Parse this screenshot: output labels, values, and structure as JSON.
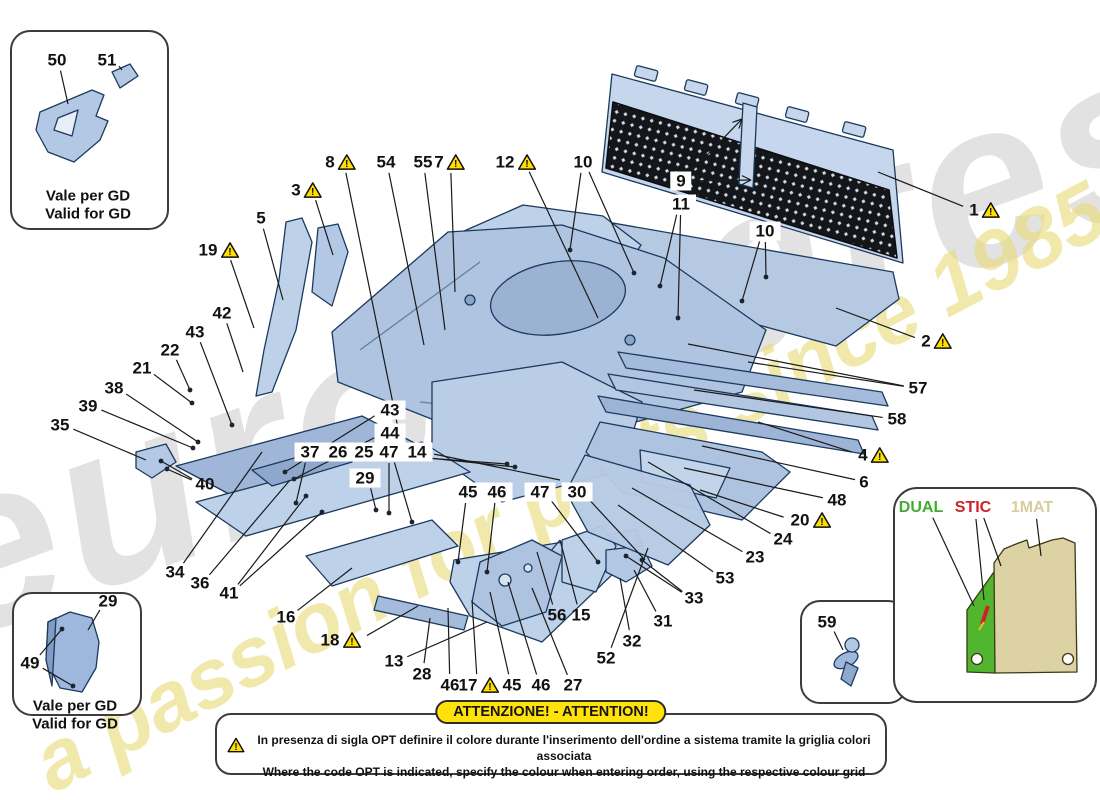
{
  "watermarks": {
    "brand": "eurospares",
    "tagline": "a passion for parts since 1985"
  },
  "banner": {
    "title": "ATTENZIONE! - ATTENTION!",
    "line_it": "In presenza di sigla OPT definire il colore durante l'inserimento dell'ordine a sistema tramite la griglia colori associata",
    "line_en": "Where the code OPT is indicated, specify the colour when entering order, using the respective colour grid"
  },
  "insets": {
    "top_left": {
      "caption1": "Vale per GD",
      "caption2": "Valid for GD"
    },
    "bottom_left": {
      "caption1": "Vale per GD",
      "caption2": "Valid for GD"
    }
  },
  "mat_legend": {
    "dual_color": "#3fae2f",
    "stic_color": "#d02027",
    "mat_color": "#d9cd9e"
  },
  "callouts": [
    {
      "n": "50",
      "x": 57,
      "y": 60,
      "tx": 68,
      "ty": 104
    },
    {
      "n": "51",
      "x": 107,
      "y": 60,
      "tx": 122,
      "ty": 70
    },
    {
      "n": "29",
      "x": 108,
      "y": 601,
      "tx": 88,
      "ty": 630
    },
    {
      "n": "49",
      "x": 30,
      "y": 663,
      "tx": 62,
      "ty": 629,
      "tx2": 73,
      "ty2": 686,
      "dot": true
    },
    {
      "n": "59",
      "x": 827,
      "y": 622,
      "tx": 843,
      "ty": 650
    },
    {
      "n": "DUAL",
      "x": 921,
      "y": 508,
      "color": "#3fae2f",
      "tx": 974,
      "ty": 606
    },
    {
      "n": "STIC",
      "x": 973,
      "y": 508,
      "color": "#d02027",
      "tx": 984,
      "ty": 600,
      "tx2": 1001,
      "ty2": 566
    },
    {
      "n": "1MAT",
      "x": 1032,
      "y": 508,
      "color": "#d9cd9e",
      "tx": 1041,
      "ty": 556
    },
    {
      "n": "3",
      "x": 307,
      "y": 190,
      "warn": true,
      "tx": 333,
      "ty": 255
    },
    {
      "n": "5",
      "x": 261,
      "y": 218,
      "tx": 283,
      "ty": 300
    },
    {
      "n": "19",
      "x": 219,
      "y": 250,
      "warn": true,
      "tx": 254,
      "ty": 328
    },
    {
      "n": "8",
      "x": 341,
      "y": 162,
      "warn": true,
      "tx": 398,
      "ty": 428
    },
    {
      "n": "54",
      "x": 386,
      "y": 162,
      "tx": 424,
      "ty": 345
    },
    {
      "n": "55",
      "x": 423,
      "y": 162,
      "tx": 445,
      "ty": 330
    },
    {
      "n": "7",
      "x": 450,
      "y": 162,
      "warn": true,
      "tx": 455,
      "ty": 292
    },
    {
      "n": "12",
      "x": 516,
      "y": 162,
      "warn": true,
      "tx": 598,
      "ty": 318
    },
    {
      "n": "10",
      "x": 583,
      "y": 162,
      "tx": 570,
      "ty": 250,
      "tx2": 634,
      "ty2": 273,
      "dot": true
    },
    {
      "n": "9",
      "x": 681,
      "y": 181,
      "boxed": true,
      "tx": 742,
      "ty": 119,
      "tx2": 751,
      "ty2": 180,
      "arrow": true
    },
    {
      "n": "11",
      "x": 681,
      "y": 204,
      "boxed": true,
      "tx": 660,
      "ty": 286,
      "tx2": 678,
      "ty2": 318,
      "dot": true
    },
    {
      "n": "10",
      "x": 765,
      "y": 231,
      "boxed": true,
      "tx": 766,
      "ty": 277,
      "tx2": 742,
      "ty2": 301,
      "dot": true
    },
    {
      "n": "1",
      "x": 985,
      "y": 210,
      "warn": true,
      "tx": 878,
      "ty": 172
    },
    {
      "n": "2",
      "x": 937,
      "y": 341,
      "warn": true,
      "tx": 836,
      "ty": 308
    },
    {
      "n": "57",
      "x": 918,
      "y": 388,
      "tx": 748,
      "ty": 362,
      "tx2": 688,
      "ty2": 344
    },
    {
      "n": "58",
      "x": 897,
      "y": 419,
      "tx": 694,
      "ty": 390
    },
    {
      "n": "4",
      "x": 874,
      "y": 455,
      "warn": true,
      "tx": 758,
      "ty": 422
    },
    {
      "n": "6",
      "x": 864,
      "y": 482,
      "tx": 702,
      "ty": 446
    },
    {
      "n": "48",
      "x": 837,
      "y": 500,
      "tx": 684,
      "ty": 468
    },
    {
      "n": "20",
      "x": 811,
      "y": 520,
      "warn": true,
      "tx": 700,
      "ty": 490
    },
    {
      "n": "24",
      "x": 783,
      "y": 539,
      "tx": 648,
      "ty": 462
    },
    {
      "n": "23",
      "x": 755,
      "y": 557,
      "tx": 632,
      "ty": 488
    },
    {
      "n": "53",
      "x": 725,
      "y": 578,
      "tx": 618,
      "ty": 505
    },
    {
      "n": "33",
      "x": 694,
      "y": 598,
      "tx": 626,
      "ty": 556,
      "tx2": 642,
      "ty2": 560,
      "dot": true
    },
    {
      "n": "31",
      "x": 663,
      "y": 621,
      "tx": 634,
      "ty": 570
    },
    {
      "n": "32",
      "x": 632,
      "y": 641,
      "tx": 620,
      "ty": 578
    },
    {
      "n": "52",
      "x": 606,
      "y": 658,
      "tx": 648,
      "ty": 548
    },
    {
      "n": "15",
      "x": 581,
      "y": 615,
      "tx": 560,
      "ty": 540
    },
    {
      "n": "56",
      "x": 557,
      "y": 615,
      "tx": 537,
      "ty": 552
    },
    {
      "n": "27",
      "x": 573,
      "y": 685,
      "tx": 532,
      "ty": 588
    },
    {
      "n": "46",
      "x": 541,
      "y": 685,
      "tx": 508,
      "ty": 582
    },
    {
      "n": "45",
      "x": 512,
      "y": 685,
      "tx": 490,
      "ty": 592
    },
    {
      "n": "17",
      "x": 479,
      "y": 685,
      "warn": true,
      "tx": 472,
      "ty": 600
    },
    {
      "n": "46",
      "x": 450,
      "y": 685,
      "tx": 448,
      "ty": 608
    },
    {
      "n": "28",
      "x": 422,
      "y": 674,
      "tx": 430,
      "ty": 618
    },
    {
      "n": "13",
      "x": 394,
      "y": 661,
      "tx": 487,
      "ty": 622
    },
    {
      "n": "18",
      "x": 341,
      "y": 640,
      "warn": true,
      "tx": 418,
      "ty": 606
    },
    {
      "n": "16",
      "x": 286,
      "y": 617,
      "tx": 352,
      "ty": 568
    },
    {
      "n": "41",
      "x": 229,
      "y": 593,
      "tx": 306,
      "ty": 496,
      "tx2": 322,
      "ty2": 512,
      "dot": true
    },
    {
      "n": "36",
      "x": 200,
      "y": 583,
      "tx": 290,
      "ty": 480
    },
    {
      "n": "34",
      "x": 175,
      "y": 572,
      "tx": 262,
      "ty": 452
    },
    {
      "n": "35",
      "x": 60,
      "y": 425,
      "tx": 146,
      "ty": 460
    },
    {
      "n": "39",
      "x": 88,
      "y": 406,
      "tx": 193,
      "ty": 448,
      "dot": true
    },
    {
      "n": "38",
      "x": 114,
      "y": 388,
      "tx": 198,
      "ty": 442,
      "dot": true
    },
    {
      "n": "21",
      "x": 142,
      "y": 368,
      "tx": 192,
      "ty": 403,
      "dot": true
    },
    {
      "n": "22",
      "x": 170,
      "y": 350,
      "tx": 190,
      "ty": 390,
      "dot": true
    },
    {
      "n": "43",
      "x": 195,
      "y": 332,
      "tx": 232,
      "ty": 425,
      "dot": true
    },
    {
      "n": "42",
      "x": 222,
      "y": 313,
      "tx": 243,
      "ty": 372
    },
    {
      "n": "40",
      "x": 205,
      "y": 484,
      "tx": 161,
      "ty": 461,
      "tx2": 167,
      "ty2": 469,
      "dot": true
    },
    {
      "n": "43",
      "x": 390,
      "y": 410,
      "boxed": true,
      "tx": 285,
      "ty": 472,
      "dot": true
    },
    {
      "n": "44",
      "x": 390,
      "y": 433,
      "boxed": true,
      "tx": 294,
      "ty": 479,
      "dot": true
    },
    {
      "n": "37",
      "x": 310,
      "y": 452,
      "boxed": true,
      "tx": 296,
      "ty": 503,
      "dot": true
    },
    {
      "n": "26",
      "x": 338,
      "y": 452,
      "boxed": true,
      "tx": 507,
      "ty": 464,
      "dot": true
    },
    {
      "n": "25",
      "x": 364,
      "y": 452,
      "boxed": true,
      "tx": 515,
      "ty": 467,
      "dot": true
    },
    {
      "n": "47",
      "x": 389,
      "y": 452,
      "boxed": true,
      "tx": 389,
      "ty": 513,
      "tx2": 412,
      "ty2": 522,
      "dot": true
    },
    {
      "n": "14",
      "x": 417,
      "y": 452,
      "boxed": true,
      "tx": 560,
      "ty": 480
    },
    {
      "n": "29",
      "x": 365,
      "y": 478,
      "boxed": true,
      "tx": 376,
      "ty": 510,
      "dot": true
    },
    {
      "n": "45",
      "x": 468,
      "y": 492,
      "boxed": true,
      "tx": 458,
      "ty": 562,
      "dot": true
    },
    {
      "n": "46",
      "x": 497,
      "y": 492,
      "boxed": true,
      "tx": 487,
      "ty": 572,
      "dot": true
    },
    {
      "n": "47",
      "x": 540,
      "y": 492,
      "boxed": true,
      "tx": 598,
      "ty": 562,
      "dot": true
    },
    {
      "n": "30",
      "x": 577,
      "y": 492,
      "boxed": true,
      "tx": 645,
      "ty": 560
    }
  ]
}
